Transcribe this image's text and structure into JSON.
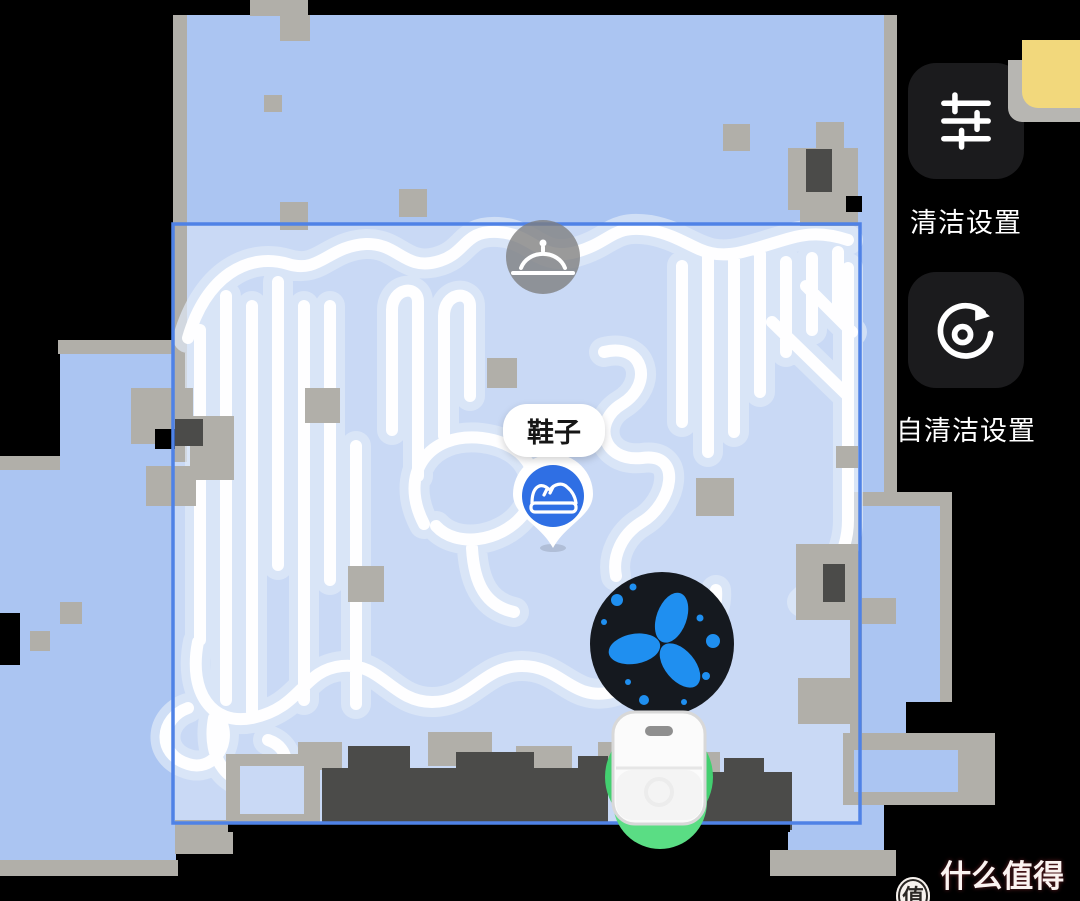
{
  "map": {
    "zone": {
      "label": "鞋子",
      "type": "selected-clean-zone"
    },
    "markers": {
      "shoe": {
        "label": "鞋子",
        "icon": "shoe-icon"
      },
      "bell": {
        "icon": "cloche-icon"
      },
      "robot": {
        "icon": "robot-vacuum-icon"
      },
      "status": {
        "icon": "fan-spray-icon"
      }
    }
  },
  "panel": {
    "buttons": [
      {
        "id": "clean-settings",
        "label": "清洁设置",
        "icon": "sliders-icon"
      },
      {
        "id": "self-clean-settings",
        "label": "自清洁设置",
        "icon": "self-clean-rotate-icon"
      }
    ]
  },
  "watermark": {
    "badge": "值",
    "site": "什么值得买"
  },
  "colors": {
    "floor": "#abc5f2",
    "zoneFill": "#c9d9f5",
    "zoneBorder": "#4f82e6",
    "wall": "#b1afa9",
    "darkBlock": "#4b4b49",
    "haloColor": "#e0eaf8",
    "traceColor": "#ffffff",
    "markerBlue": "#2f6fe4",
    "fanBlue": "#1f8ff0",
    "fanDisc": "#15191f",
    "robotGreen": "#43cf70",
    "robotGreenLight": "#5add84",
    "btnBg": "#1b1b1d",
    "noteYellow": "#f2d87c",
    "bellGray": "#7d7d7d"
  }
}
